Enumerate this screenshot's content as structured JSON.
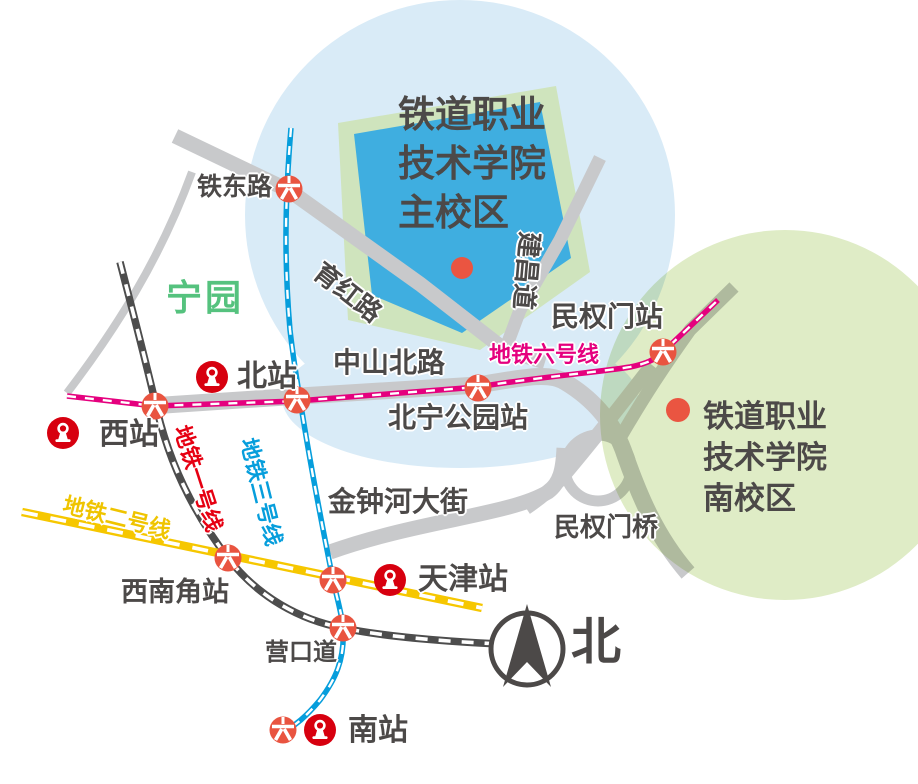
{
  "map": {
    "main_campus": {
      "lines": [
        "铁道职业",
        "技术学院",
        "主校区"
      ],
      "marker_color": "#EA5541"
    },
    "south_campus": {
      "lines": [
        "铁道职业",
        "技术学院",
        "南校区"
      ],
      "marker_color": "#EA5541"
    },
    "park_label": "宁园",
    "compass_label": "北",
    "stations": {
      "tiedonglu": "铁东路",
      "north": "北站",
      "west": "西站",
      "tianjin": "天津站",
      "south": "南站",
      "xinanjiao": "西南角站",
      "yingkoudao": "营口道",
      "beining_park": "北宁公园站",
      "minquanmen": "民权门站"
    },
    "roads": {
      "yuhong": "育红路",
      "jianchang": "建昌道",
      "zhongshanbei": "中山北路",
      "jinzhonghe": "金钟河大街",
      "minquanmen_bridge": "民权门桥"
    },
    "metro_lines": {
      "line1": {
        "label": "地铁一号线",
        "label_color": "#E60012",
        "line_color": "#4D4D4D"
      },
      "line2": {
        "label": "地铁二号线",
        "label_color": "#EFC400",
        "line_color": "#F6C700"
      },
      "line3": {
        "label": "地铁三号线",
        "label_color": "#069EDC",
        "line_color": "#069EDC"
      },
      "line6": {
        "label": "地铁六号线",
        "label_color": "#E5007E",
        "line_color": "#E5007E"
      }
    },
    "colors": {
      "area_blue": "#D9EBF7",
      "area_green": "#DFECC6",
      "campus_block_green": "#CFE4BD",
      "campus_block_blue": "#3FAEE0",
      "road_gray": "#C8C9CB",
      "text_dark": "#4C4948",
      "station_icon_red": "#E95440",
      "railway_logo_red": "#D7000F",
      "park_green": "#55C27E"
    }
  }
}
